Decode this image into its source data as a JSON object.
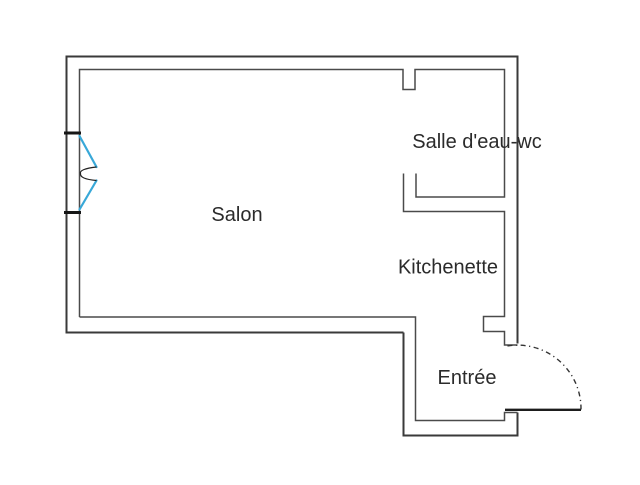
{
  "meta": {
    "type": "apartment-floor-plan",
    "background": "#ffffff"
  },
  "colors": {
    "background": "#ffffff",
    "wall_outer": "#3a3a3a",
    "wall_inner": "#4a4a4a",
    "window_tick": "#161616",
    "window_accent": "#38a8d8",
    "window_detail": "#222222",
    "door_arc": "#333333",
    "door_leaf": "#1d1d1d",
    "text": "#2b2b2b"
  },
  "rooms": {
    "salon": {
      "label": "Salon"
    },
    "salle_eau": {
      "label": "Salle d'eau-wc"
    },
    "kitchenette": {
      "label": "Kitchenette"
    },
    "entree": {
      "label": "Entrée"
    }
  },
  "symbols": {
    "window": "double-casement-window-left-wall",
    "entry_door": "entry-door-with-quarter-swing-arc-bottom-right",
    "salle_eau_door": "open-doorway-no-leaf"
  }
}
